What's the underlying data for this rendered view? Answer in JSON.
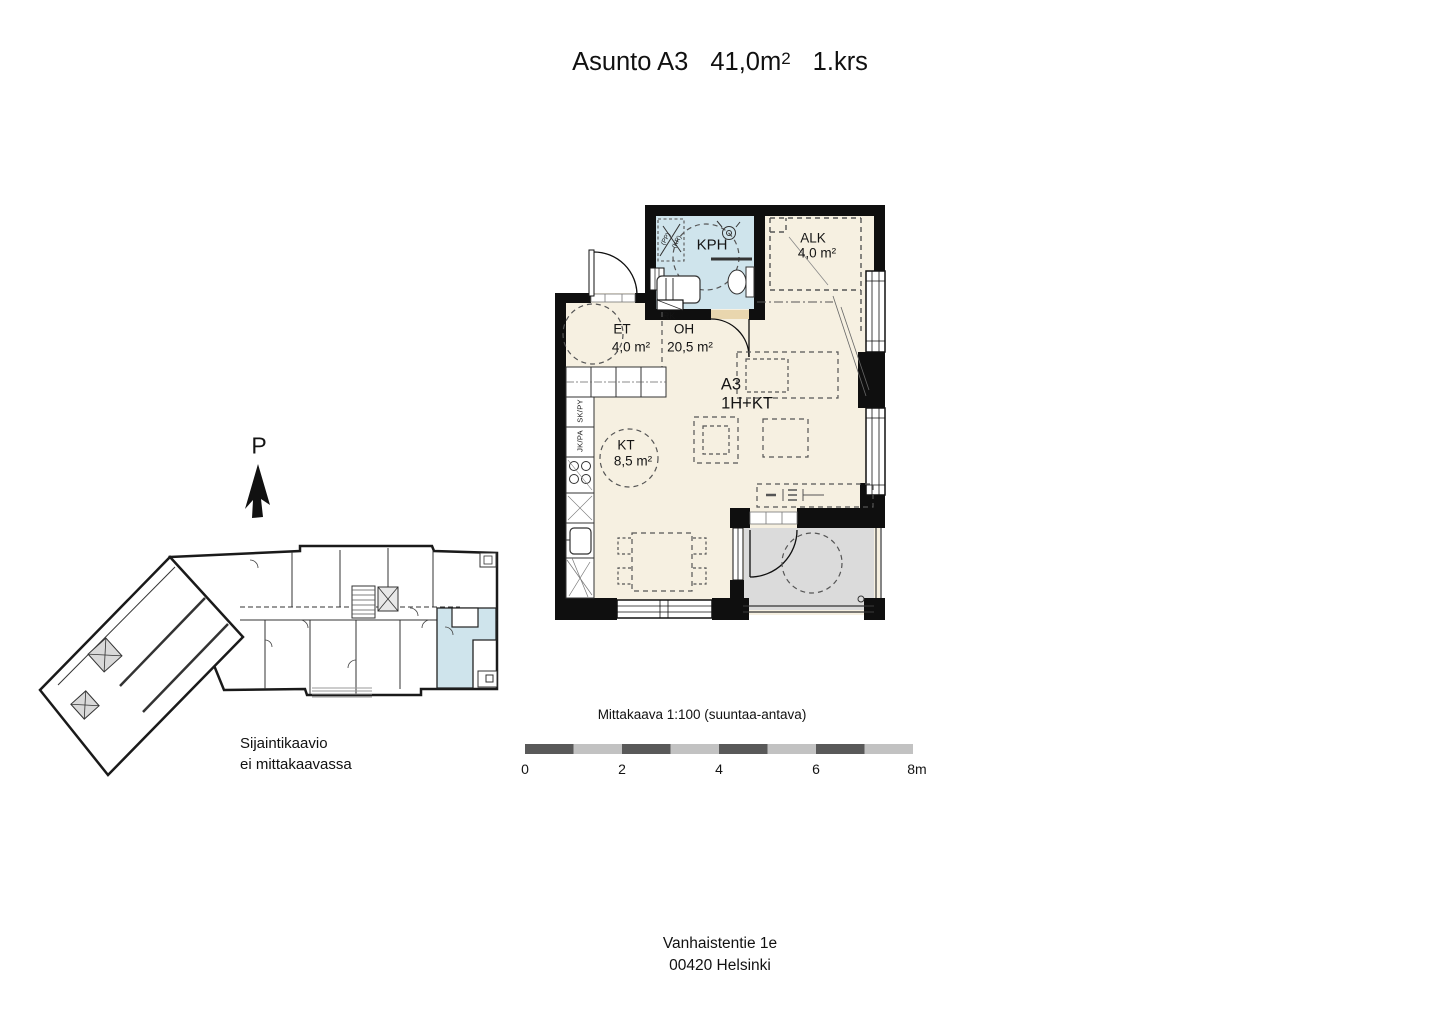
{
  "title": {
    "apartment": "Asunto A3",
    "area": "41,0m",
    "area_superscript": "2",
    "floor": "1.krs"
  },
  "north_arrow": {
    "label": "P"
  },
  "floor_plan": {
    "rooms": [
      {
        "key": "kph",
        "label": "KPH",
        "area": ""
      },
      {
        "key": "alk",
        "label": "ALK",
        "area": "4,0 m²"
      },
      {
        "key": "et",
        "label": "ET",
        "area": "4,0 m²"
      },
      {
        "key": "oh",
        "label": "OH",
        "area": "20,5 m²"
      },
      {
        "key": "kt",
        "label": "KT",
        "area": "8,5 m²"
      }
    ],
    "apartment_label": {
      "code": "A3",
      "type": "1H+KT"
    },
    "annotations": {
      "rk": "RK",
      "sk_py": "SK/PY",
      "jk_pa": "JK/PA",
      "pp": "(PP)",
      "kr": "(KR)"
    }
  },
  "site_plan": {
    "caption_line1": "Sijaintikaavio",
    "caption_line2": "ei mittakaavassa"
  },
  "scale_bar": {
    "title": "Mittakaava 1:100 (suuntaa-antava)",
    "ticks": [
      "0",
      "2",
      "4",
      "6",
      "8m"
    ]
  },
  "address": {
    "line1": "Vanhaistentie 1e",
    "line2": "00420 Helsinki"
  },
  "colors": {
    "wall": "#0f0f0f",
    "floor": "#f6f0e1",
    "bathroom": "#cfe4ec",
    "balcony": "#dbdbdb",
    "threshold": "#e9d6ae",
    "highlight_apartment": "#cfe4ec",
    "scale_dark": "#595959",
    "scale_light": "#c2c2c2"
  }
}
